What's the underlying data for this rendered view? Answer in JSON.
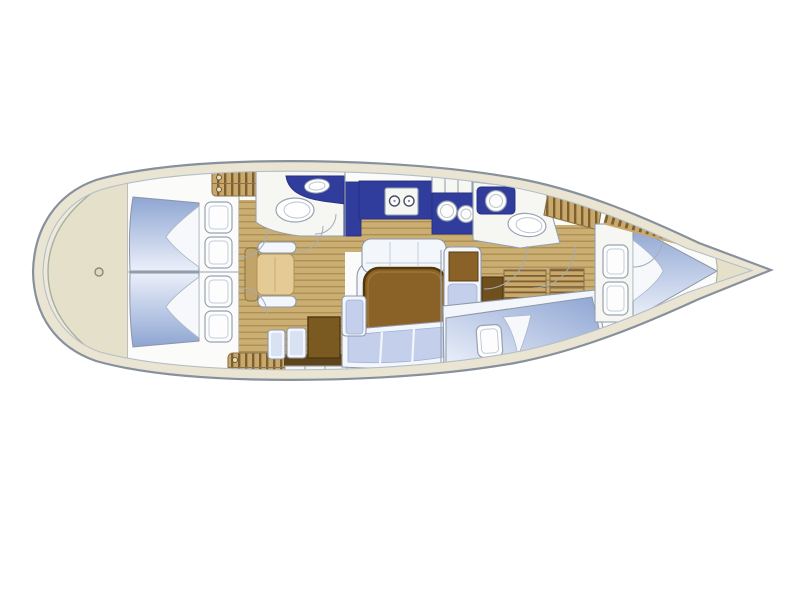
{
  "diagram": {
    "type": "sailing-yacht-interior-floorplan",
    "orientation": "bow-right",
    "regions": [
      "stern-swim-platform",
      "aft-cabin-port",
      "aft-cabin-starboard",
      "companionway-steps",
      "aft-head",
      "galley",
      "salon-settee-and-table",
      "nav-station",
      "mid-berth-cabin",
      "forward-head",
      "v-berth-cabin",
      "anchor-locker"
    ]
  },
  "colors": {
    "deck": "#e9e5d2",
    "deckShade": "#e4e0ca",
    "deckLight": "#edeadb",
    "outline": "#87909c",
    "innerLine": "#b5bdc7",
    "floor": "#fbfbfa",
    "wood": "#cbaf72",
    "woodStripe": "#ae8f55",
    "hatchWood": "#c9a96b",
    "hatchStripe": "#7d5f30",
    "hatchBorder": "#8a734a",
    "berthDark": "#8ea5d2",
    "berthLight": "#ebf0fa",
    "fold": "#f6f8fc",
    "pillow": "#fdfdfe",
    "pillowEdge": "#97a2b2",
    "counter": "#303d9d",
    "fixture": "#f6f6f3",
    "fixtureEdge": "#93a0ae",
    "table": "#8a6228",
    "tableEdge": "#513809",
    "tableInner": "#a67c3a",
    "cushion": "#c3cfeb",
    "cushionEdge": "#9fb0d6",
    "trim": "#f3f6fb",
    "chairTan": "#c2a368",
    "chairSeat": "#e4cb96",
    "deskBrown": "#7b5a22",
    "darkStrip": "#5e441a",
    "stool": "#6f4f1e",
    "locker": "#8a6228",
    "wallLine": "#9aa3ad",
    "arcLine": "#a3acb7",
    "sternRing": "#a9ae9e"
  }
}
